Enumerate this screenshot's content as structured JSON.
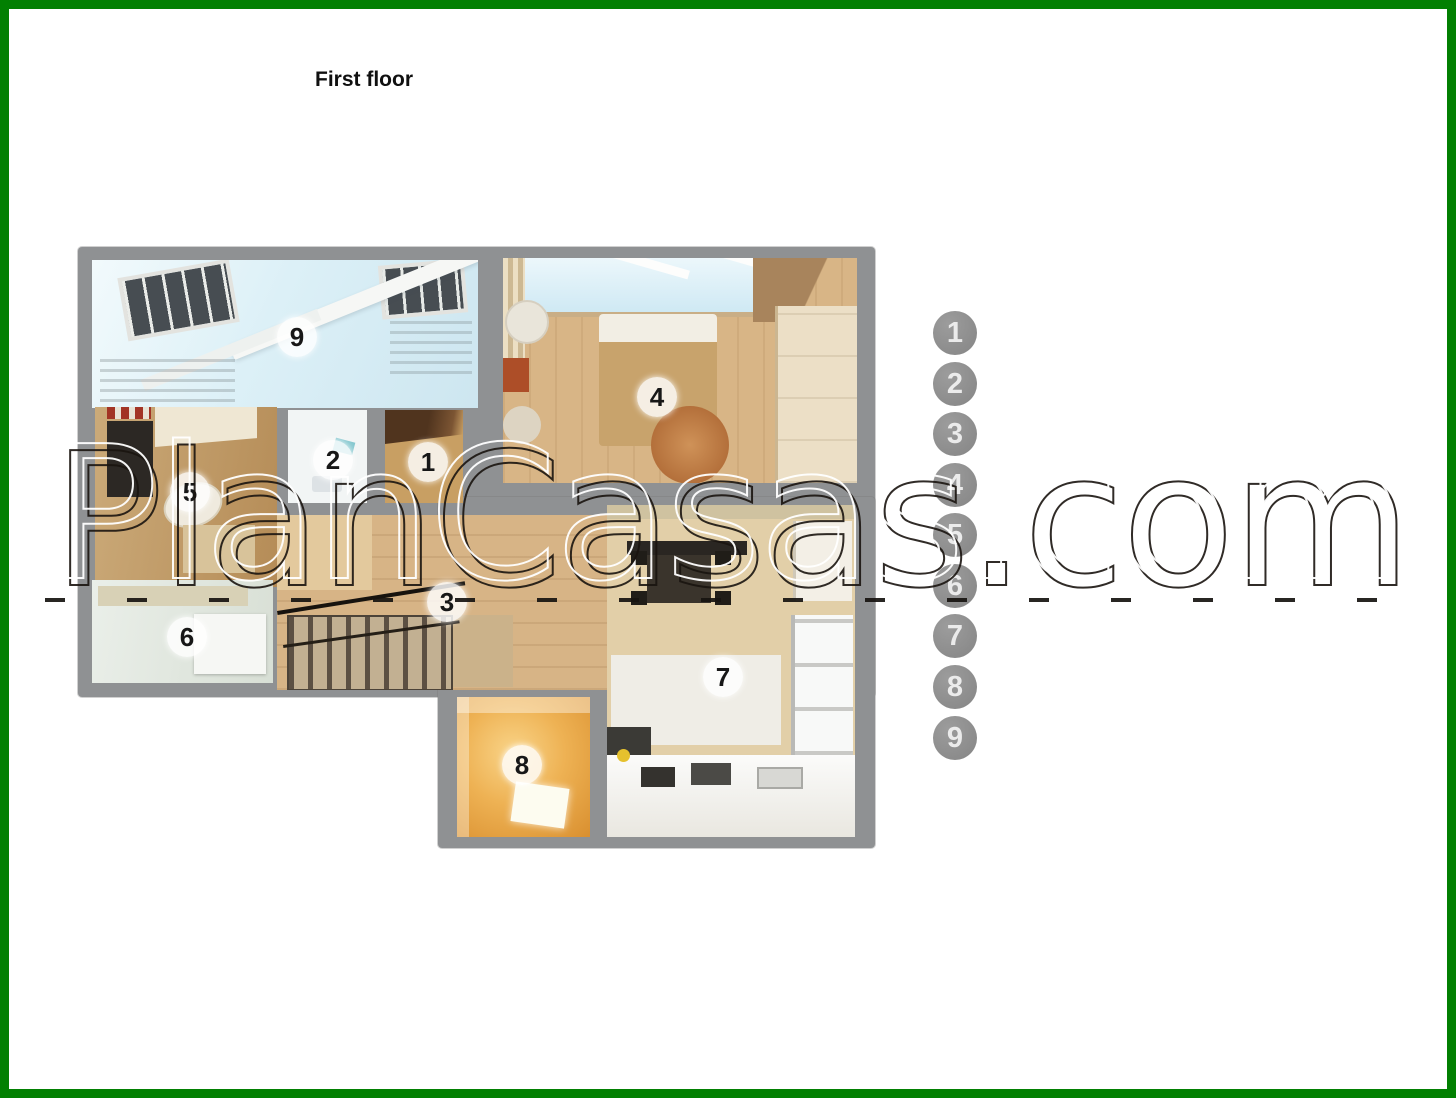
{
  "header": {
    "title": "First floor"
  },
  "watermark": {
    "text": "PlanCasas.com"
  },
  "floor_plan": {
    "rooms": [
      {
        "number": "1"
      },
      {
        "number": "2"
      },
      {
        "number": "3"
      },
      {
        "number": "4"
      },
      {
        "number": "5"
      },
      {
        "number": "6"
      },
      {
        "number": "7"
      },
      {
        "number": "8"
      },
      {
        "number": "9"
      }
    ]
  },
  "legend": {
    "items": [
      {
        "number": "1",
        "area": "2.3 м2"
      },
      {
        "number": "2",
        "area": "2.0 м2"
      },
      {
        "number": "3",
        "area": "13.4 м2"
      },
      {
        "number": "4",
        "area": "24.4 м2"
      },
      {
        "number": "5",
        "area": "8.1 м2"
      },
      {
        "number": "6",
        "area": "5.1 м2"
      },
      {
        "number": "7",
        "area": "21.2 м2"
      },
      {
        "number": "8",
        "area": "5.0 м2"
      },
      {
        "number": "9",
        "area": "14.0 м2"
      }
    ]
  },
  "colors": {
    "frame_green": "#028002",
    "wall_gray": "#8f9193",
    "legend_circle": "#8c8c8c"
  }
}
